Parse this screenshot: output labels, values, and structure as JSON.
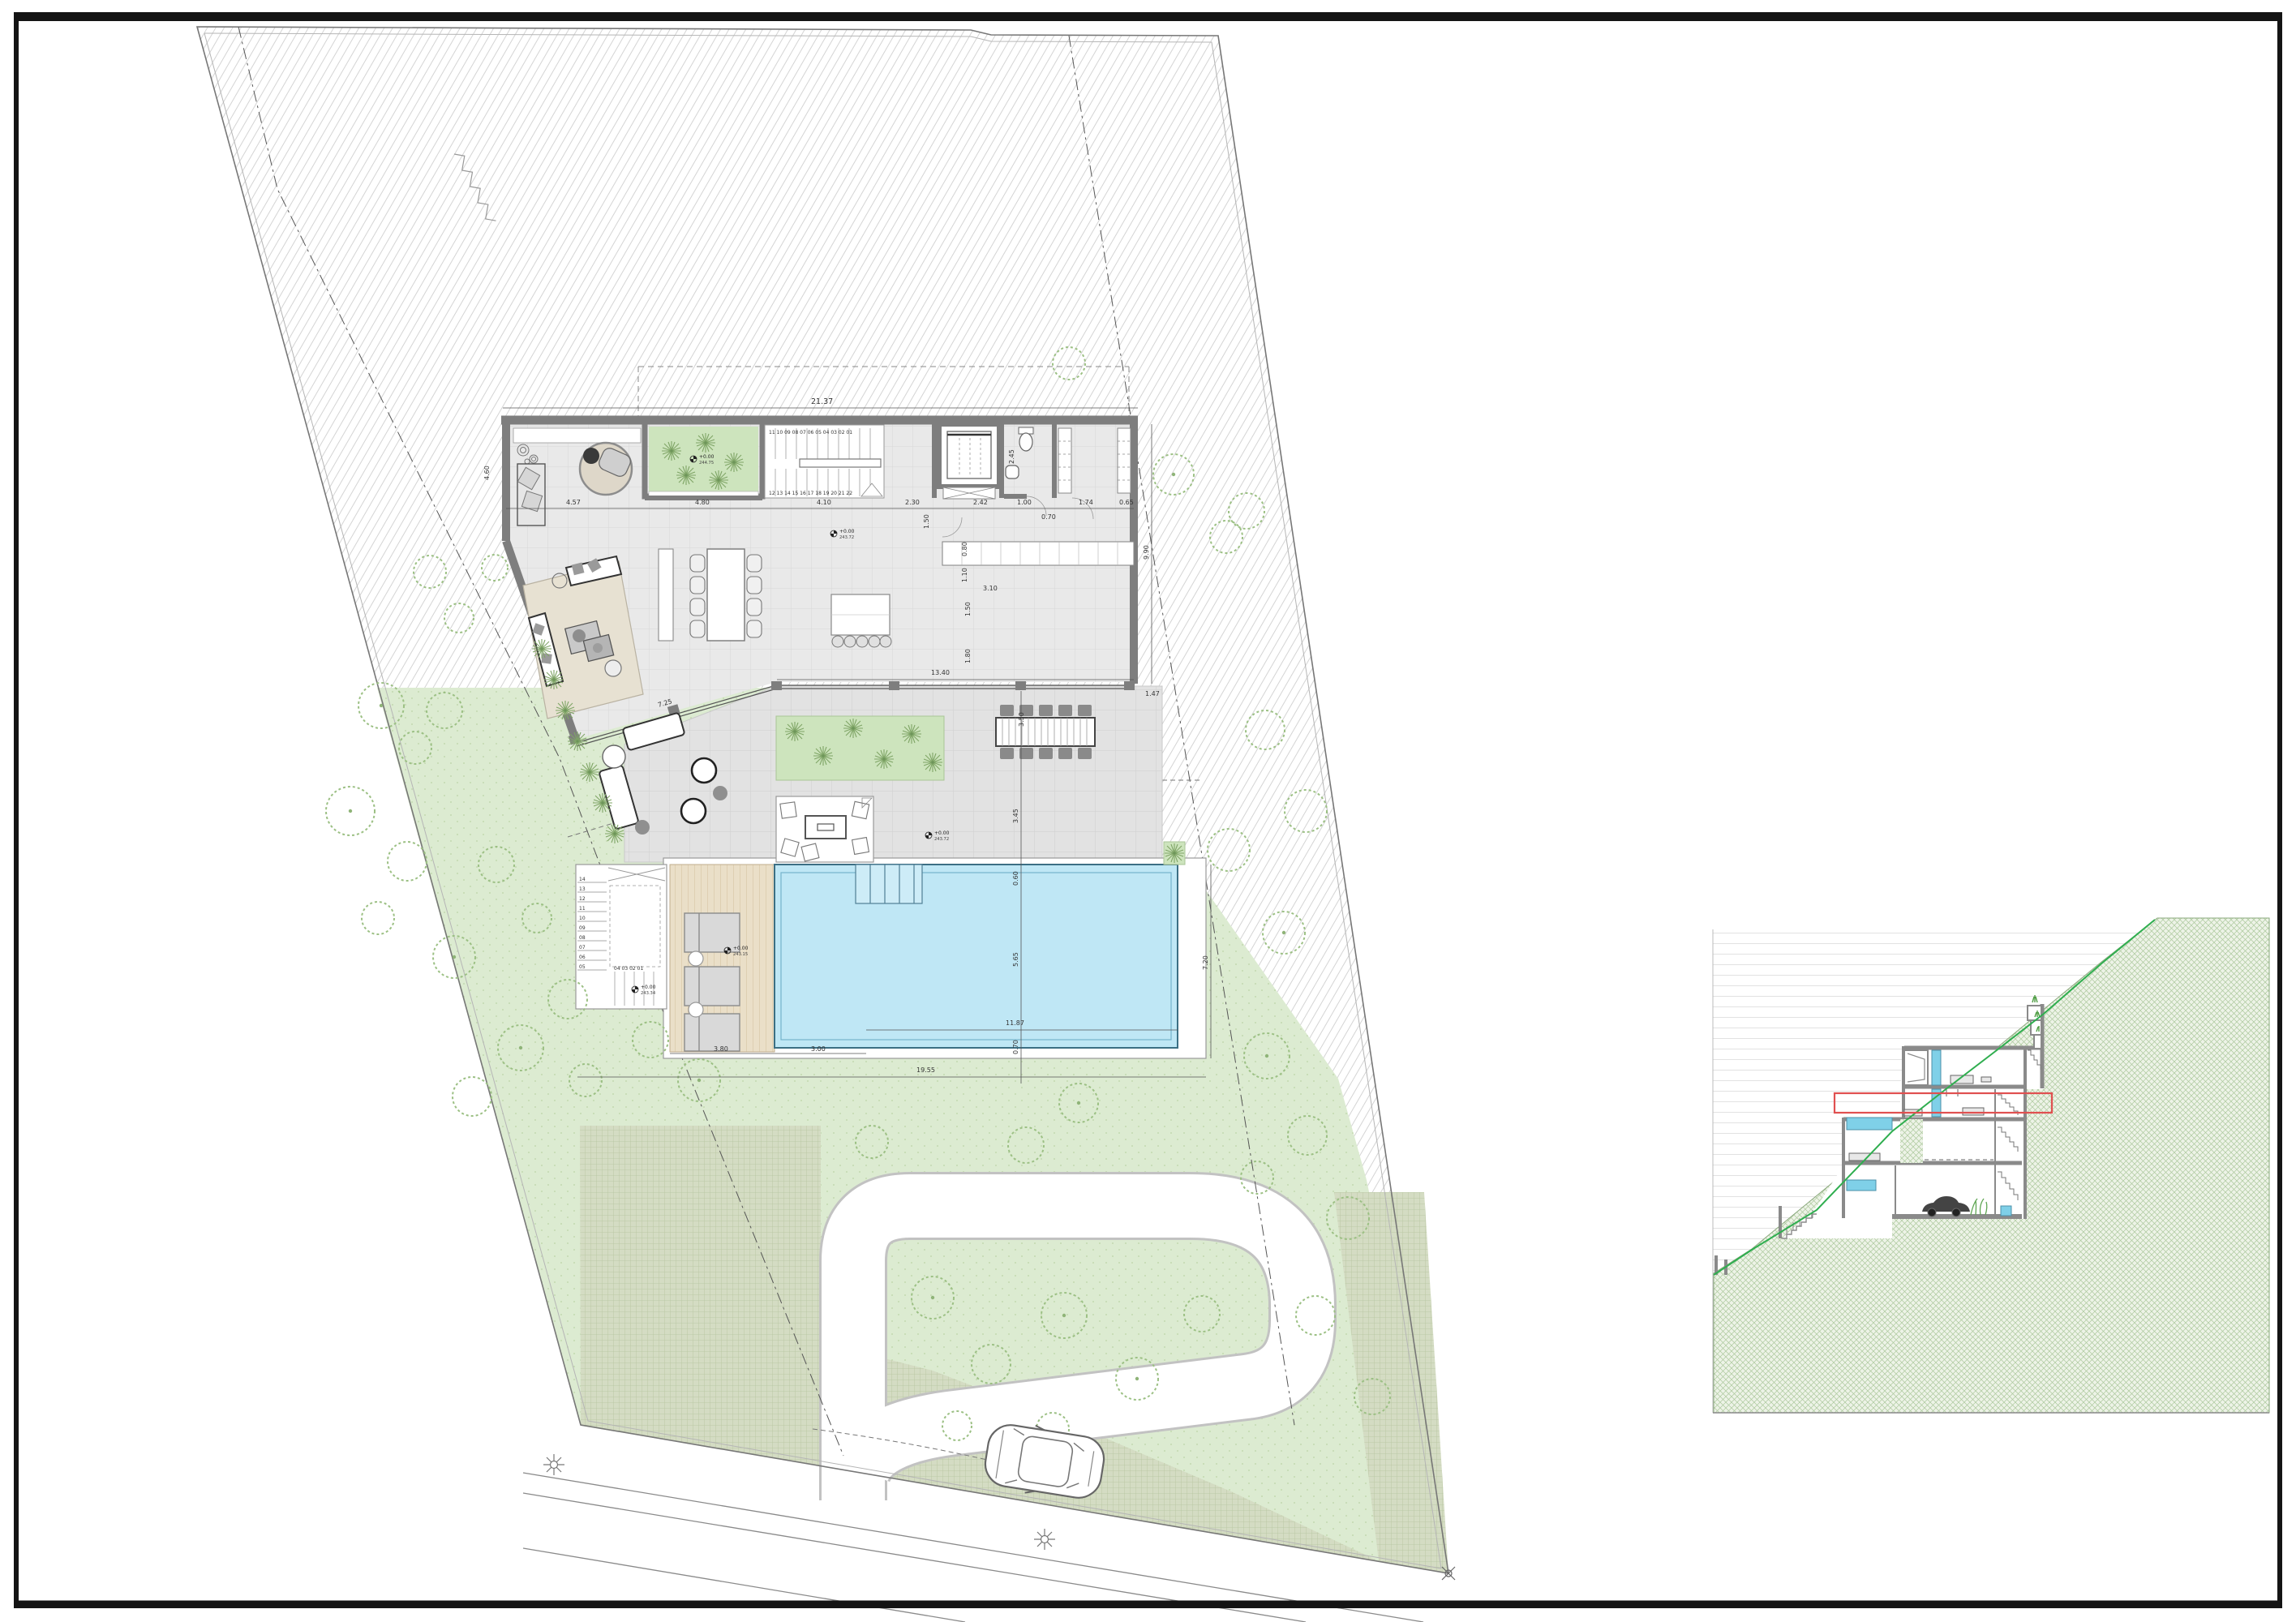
{
  "sheet": {
    "background": "#ffffff",
    "frame_color": "#141414"
  },
  "palette": {
    "wall": "#7e7e7e",
    "floor": "#e9e9e9",
    "terrace": "#e2e2e2",
    "lawn": "#dcebd1",
    "patio_green": "#cde4bd",
    "pool_water": "#bfe7f5",
    "pool_line": "#74b4cc",
    "deck_wood": "#eadfc8",
    "grass_paver": "#d4dcc3",
    "hatch_line": "#d4d4d4",
    "highlight_red": "#e05050",
    "terrain_green": "#2fae4f",
    "section_hatch": "#abc89c"
  },
  "dims": {
    "top": "21.37",
    "left": "4.60",
    "r1": "4.57",
    "r2": "4.80",
    "r3": "4.10",
    "r4": "2.30",
    "r5": "2.42",
    "r6": "1.00",
    "r7": "0.70",
    "r8": "1.74",
    "r9": "0.65",
    "bath": "2.45",
    "bathdoor": "1.50",
    "k080": "0.80",
    "k110": "1.10",
    "k310": "3.10",
    "k150": "1.50",
    "k180": "1.80",
    "east": "9.90",
    "corner": "1.47",
    "glass": "13.40",
    "angled": "7.25",
    "table": "3.50",
    "v345": "3.45",
    "v060": "0.60",
    "v565": "5.65",
    "v070": "0.70",
    "pool_len": "11.87",
    "pool_total": "19.55",
    "deck_w": "3.80",
    "steps_w": "3.00",
    "right_v": "7.20"
  },
  "levels": {
    "patio": {
      "a": "+0.00",
      "b": "244.75"
    },
    "hall": {
      "a": "+0.00",
      "b": "243.72"
    },
    "terrace": {
      "a": "+0.00",
      "b": "243.72"
    },
    "deck": {
      "a": "+0.00",
      "b": "243.15"
    },
    "stair": {
      "a": "+0.00",
      "b": "243.34"
    }
  },
  "stairs": {
    "upper": "11 10 09 08 07 06 05 04 03 02 01",
    "lower": "12 13 14 15 16 17 18 19 20 21 22"
  },
  "outdoor_stair": {
    "col": [
      "14",
      "13",
      "12",
      "11",
      "10",
      "09",
      "08",
      "07",
      "06",
      "05"
    ],
    "row": "04  03  02  01"
  }
}
